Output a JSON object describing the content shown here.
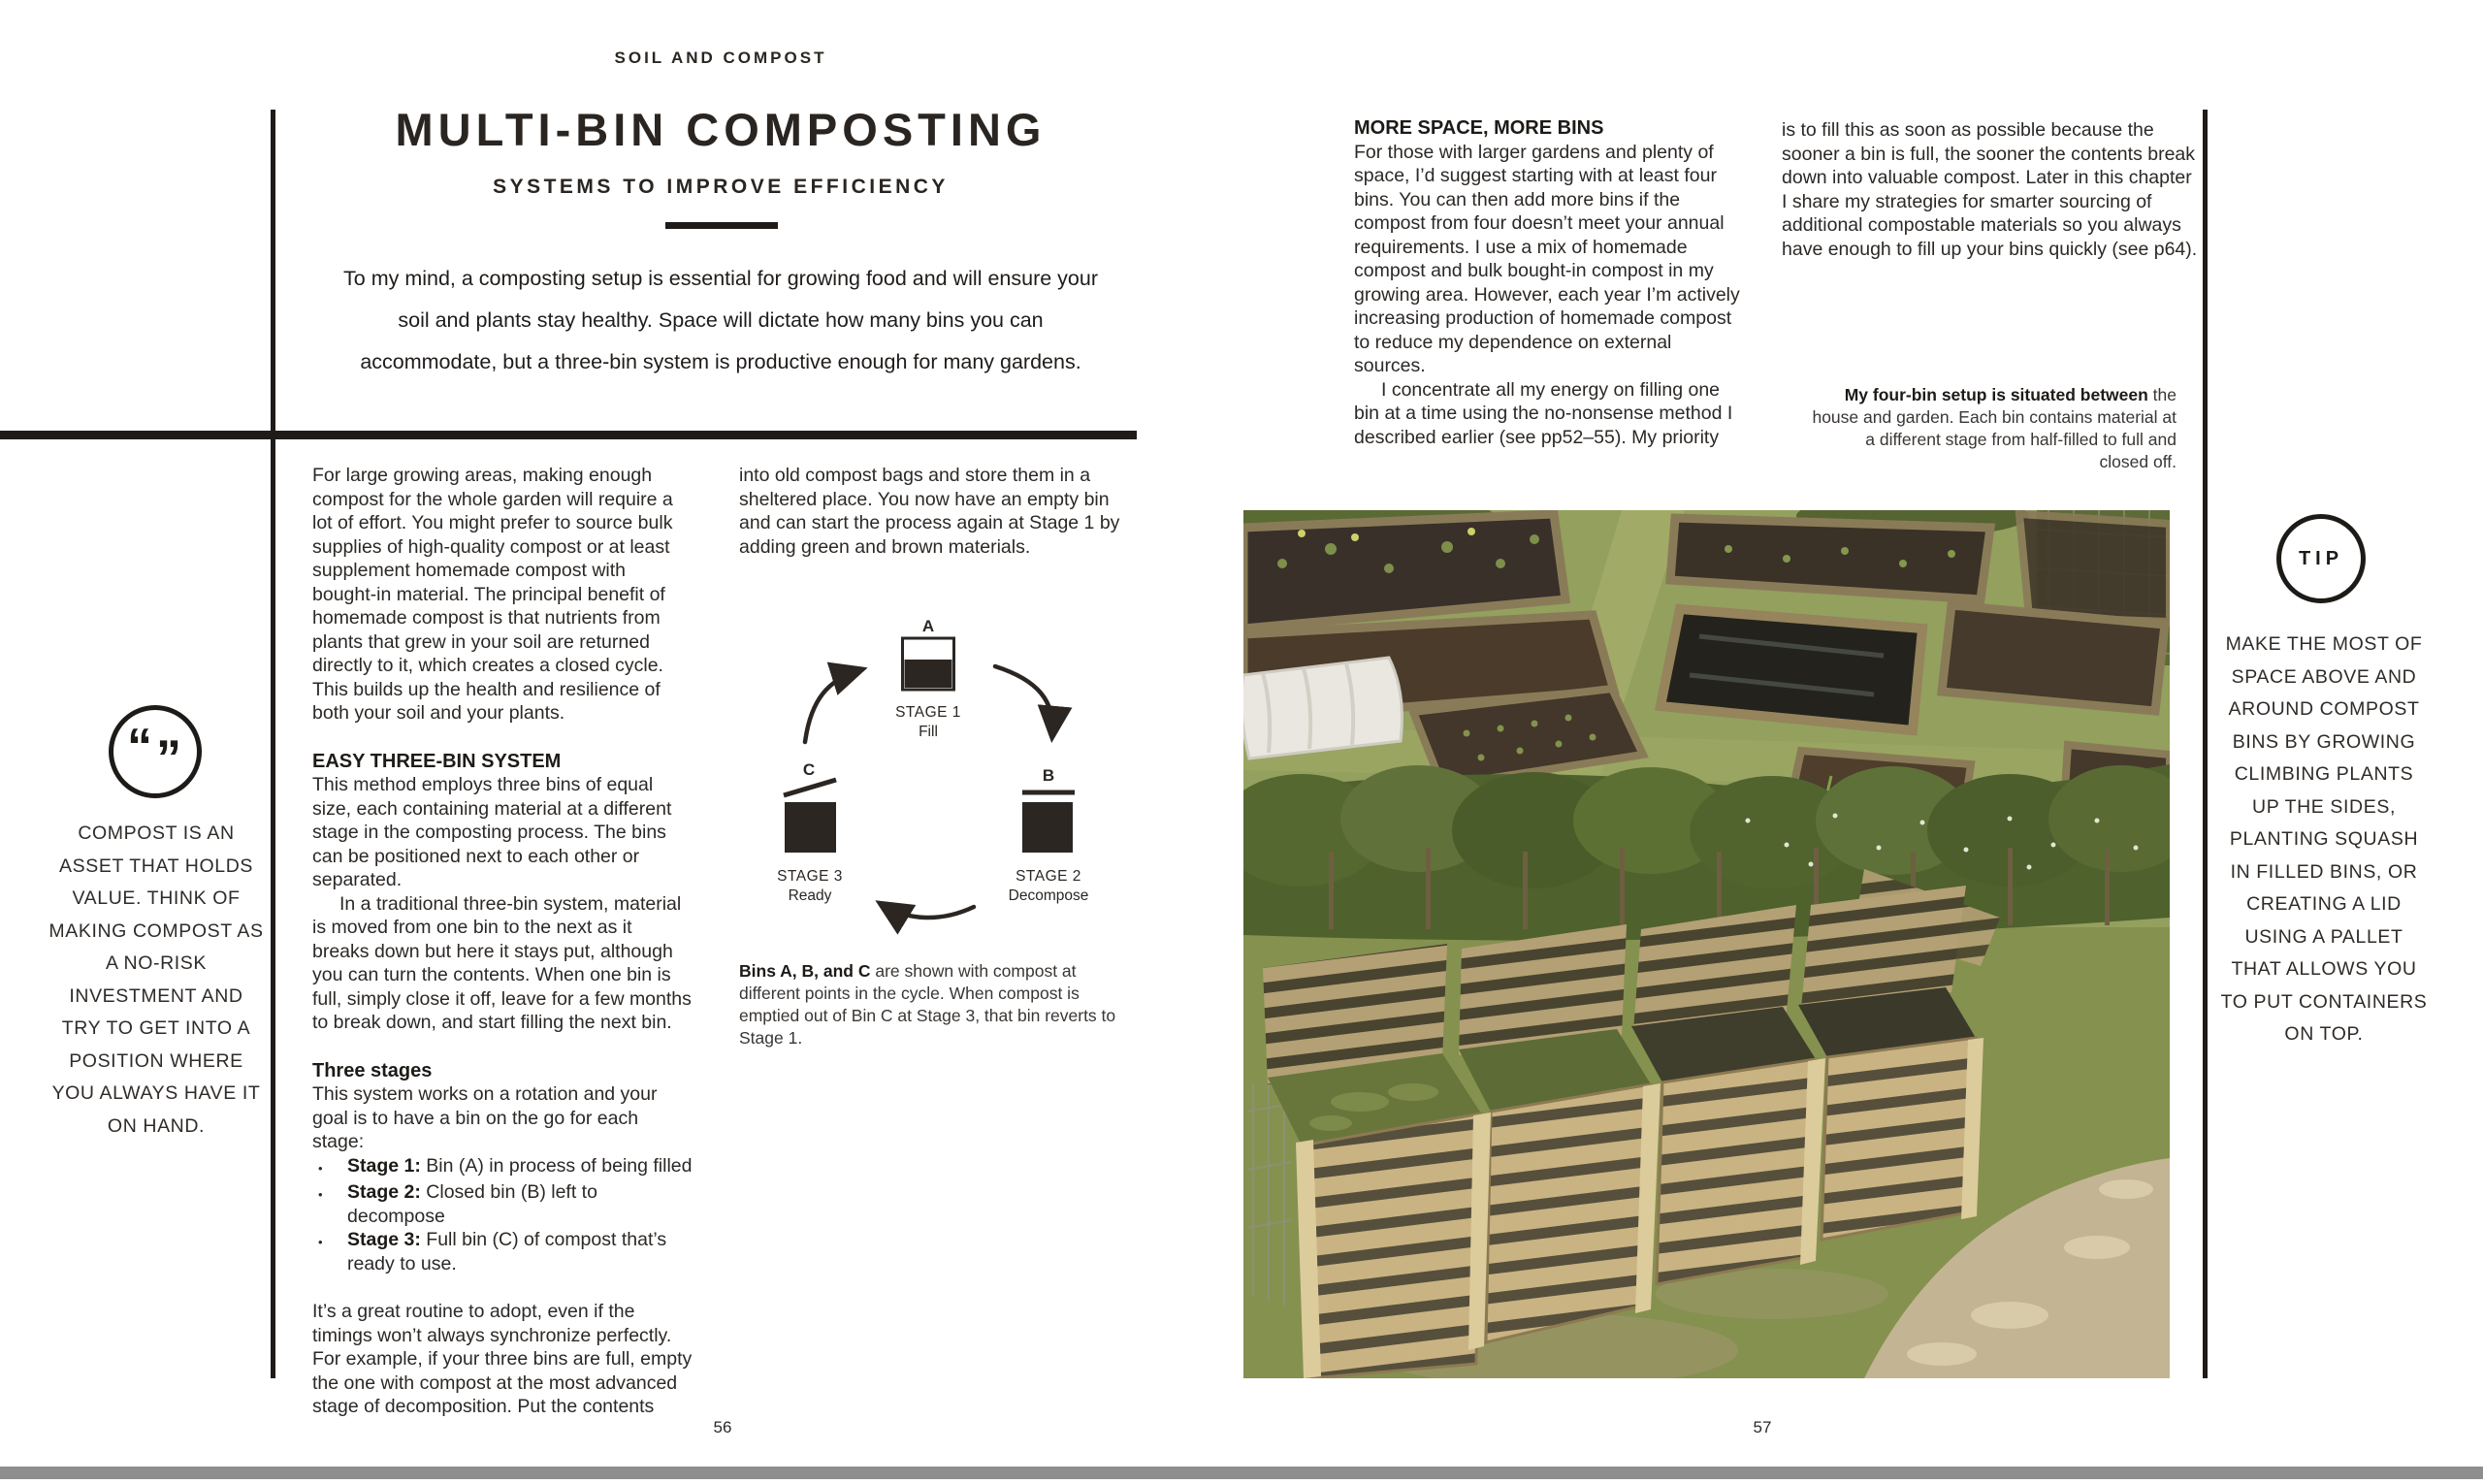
{
  "colors": {
    "ink": "#231f20",
    "paper": "#ffffff",
    "bottom_bar": "#8e8e8e",
    "photo_wood": "#c9b383",
    "photo_grass": "#8f9c58",
    "photo_soil": "#433729",
    "photo_hedge": "#4f612d"
  },
  "page_left": {
    "kicker": "SOIL AND COMPOST",
    "title": "MULTI-BIN COMPOSTING",
    "subtitle": "SYSTEMS TO IMPROVE EFFICIENCY",
    "intro": "To my mind, a composting setup is essential for growing food and will ensure your soil and plants stay healthy. Space will dictate how many bins you can accommodate, but a three-bin system is productive enough for many gardens.",
    "pull_quote": {
      "open_quote": "“",
      "close_quote": "”",
      "text": "COMPOST IS AN ASSET THAT HOLDS VALUE. THINK OF MAKING COMPOST AS A NO-RISK INVESTMENT AND TRY TO GET INTO A POSITION WHERE YOU ALWAYS HAVE IT ON HAND."
    },
    "col1": {
      "p1": "For large growing areas, making enough compost for the whole garden will require a lot of effort. You might prefer to source bulk supplies of high-quality compost or at least supplement homemade compost with bought-in material. The principal benefit of homemade compost is that nutrients from plants that grew in your soil are returned directly to it, which creates a closed cycle. This builds up the health and resilience of both your soil and your plants.",
      "h1": "EASY THREE-BIN SYSTEM",
      "p2": "This method employs three bins of equal size, each containing material at a different stage in the composting process. The bins can be positioned next to each other or separated.",
      "p3": "In a traditional three-bin system, material is moved from one bin to the next as it breaks down but here it stays put, although you can turn the contents. When one bin is full, simply close it off, leave for a few months to break down, and start filling the next bin.",
      "h2": "Three stages",
      "p4": "This system works on a rotation and your goal is to have a bin on the go for each stage:",
      "bullet_glyph": "•",
      "bullets": [
        {
          "lead": "Stage 1:",
          "text": " Bin (A) in process of being filled"
        },
        {
          "lead": "Stage 2:",
          "text": " Closed bin (B) left to decompose"
        },
        {
          "lead": "Stage 3:",
          "text": " Full bin (C) of compost that’s ready to use."
        }
      ],
      "p5": "It’s a great routine to adopt, even if the timings won’t always synchronize perfectly. For example, if your three bins are full, empty the one with compost at the most advanced stage of decomposition. Put the contents"
    },
    "col2": {
      "p1": "into old compost bags and store them in a sheltered place. You now have an empty bin and can start the process again at Stage 1 by adding green and brown materials.",
      "caption_lead": "Bins A, B, and C",
      "caption_rest": " are shown with compost at different points in the cycle. When compost is emptied out of Bin C at Stage 3, that bin reverts to Stage 1."
    },
    "diagram": {
      "stages": [
        {
          "letter": "A",
          "stage": "STAGE 1",
          "action": "Fill"
        },
        {
          "letter": "B",
          "stage": "STAGE 2",
          "action": "Decompose"
        },
        {
          "letter": "C",
          "stage": "STAGE 3",
          "action": "Ready"
        }
      ]
    },
    "page_number": "56"
  },
  "page_right": {
    "col1": {
      "h1": "MORE SPACE, MORE BINS",
      "p1": "For those with larger gardens and plenty of space, I’d suggest starting with at least four bins. You can then add more bins if the compost from four doesn’t meet your annual requirements. I use a mix of homemade compost and bulk bought-in compost in my growing area. However, each year I’m actively increasing production of homemade compost to reduce my dependence on external sources.",
      "p2": "I concentrate all my energy on filling one bin at a time using the no-nonsense method I described earlier (see pp52–55). My priority"
    },
    "col2": {
      "p1": "is to fill this as soon as possible because the sooner a bin is full, the sooner the contents break down into valuable compost. Later in this chapter I share my strategies for smarter sourcing of additional compostable materials so you always have enough to fill up your bins quickly (see p64)."
    },
    "caption_lead": "My four-bin setup is situated between",
    "caption_rest": " the house and garden. Each bin contains material at a different stage from half-filled to full and closed off.",
    "tip": {
      "label": "TIP",
      "text": "MAKE THE MOST OF SPACE ABOVE AND AROUND COMPOST BINS BY GROWING CLIMBING PLANTS UP THE SIDES, PLANTING SQUASH IN FILLED BINS, OR CREATING A LID USING A PALLET THAT ALLOWS YOU TO PUT CONTAINERS ON TOP.",
      "page_number_unused": ""
    },
    "page_number": "57"
  }
}
